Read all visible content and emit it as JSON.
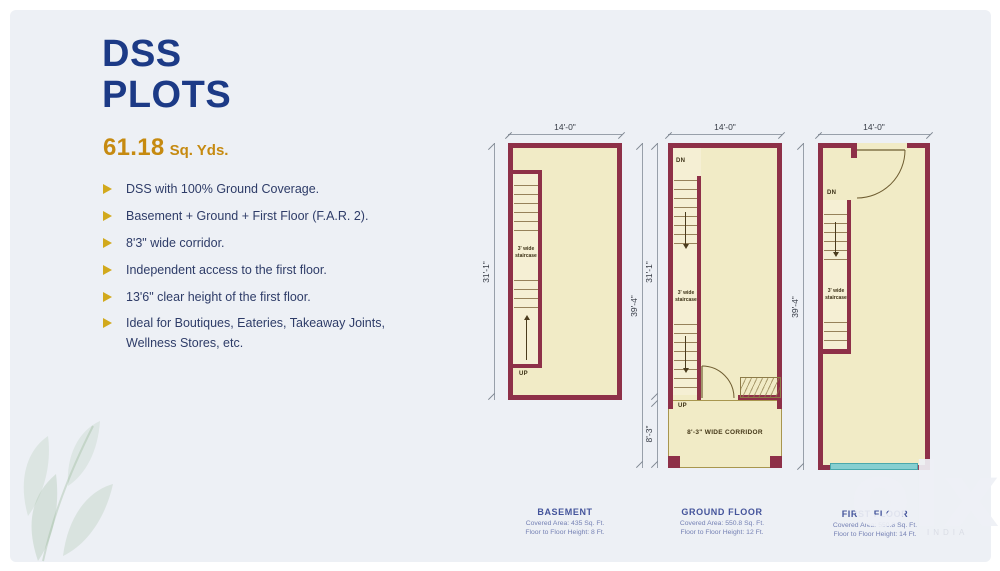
{
  "slide": {
    "title_line1": "DSS",
    "title_line2": "PLOTS",
    "area_value": "61.18",
    "area_unit": "Sq. Yds.",
    "features": [
      "DSS  with 100% Ground Coverage.",
      "Basement + Ground + First Floor (F.A.R. 2).",
      "8'3\" wide corridor.",
      "Independent access to the first floor.",
      "13'6\" clear height of the first floor.",
      "Ideal for Boutiques, Eateries, Takeaway Joints, Wellness Stores, etc."
    ]
  },
  "plans": {
    "basement": {
      "width_dim": "14'-0\"",
      "height_dim": "31'-1\"",
      "stair_label": "3' wide staircase",
      "up_label": "UP",
      "title": "BASEMENT",
      "covered_area": "Covered Area: 435 Sq. Ft.",
      "floor_height": "Floor to Floor Height: 8 Ft."
    },
    "ground": {
      "width_dim": "14'-0\"",
      "outer_height_dim": "39'-4\"",
      "inner_height_dim": "31'-1\"",
      "corridor_height_dim": "8'-3\"",
      "dn_label": "DN",
      "up_label": "UP",
      "stair_label": "3' wide staircase",
      "corridor_label": "8'-3\" WIDE CORRIDOR",
      "title": "GROUND FLOOR",
      "covered_area": "Covered Area: 550.8 Sq. Ft.",
      "floor_height": "Floor to Floor Height: 12 Ft."
    },
    "first": {
      "width_dim": "14'-0\"",
      "height_dim": "39'-4\"",
      "dn_label": "DN",
      "stair_label": "3' wide staircase",
      "title": "FIRST FLOOR",
      "covered_area": "Covered Area: 550.8 Sq. Ft.",
      "floor_height": "Floor to Floor Height: 14 Ft."
    }
  },
  "watermark": {
    "text": "olx",
    "subtext": "INDIA"
  },
  "colors": {
    "wall_maroon": "#8e3048",
    "plan_fill": "#f1ebc6",
    "title_navy": "#1c3a86",
    "accent_gold": "#c68a10",
    "bullet_gold": "#d2a91c",
    "teal_strip": "#86cfd1",
    "slide_bg": "#edf0f5"
  }
}
